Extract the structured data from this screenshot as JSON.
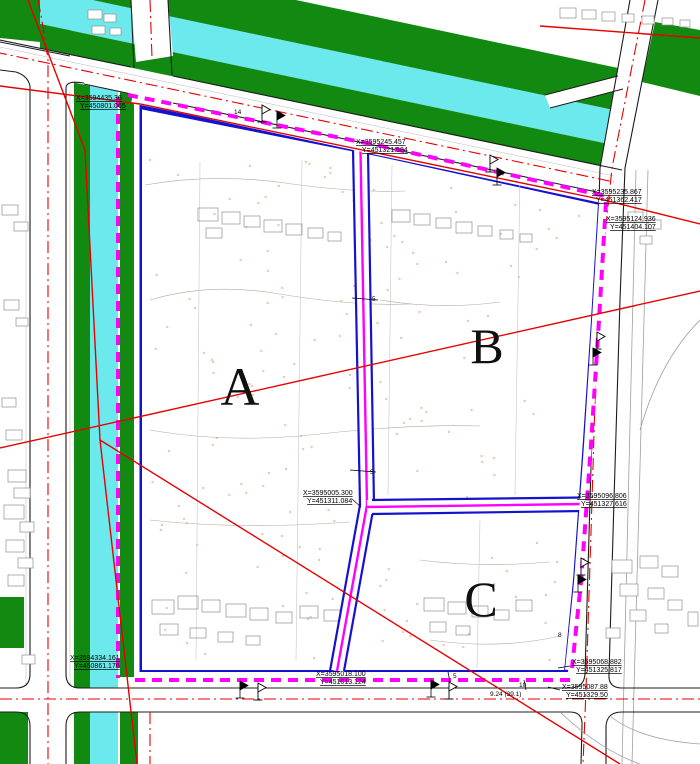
{
  "map": {
    "type": "cad-site-plan",
    "parcel_labels": {
      "a": "A",
      "b": "B",
      "c": "C"
    },
    "coordinate_labels": [
      {
        "x": "X=3594435.36",
        "y": "Y=450801.065"
      },
      {
        "x": "X=3595245.457",
        "y": "Y=451321.584"
      },
      {
        "x": "X=3595235.867",
        "y": "Y=451362.417"
      },
      {
        "x": "X=3595124.936",
        "y": "Y=451404.107"
      },
      {
        "x": "X=3595005.300",
        "y": "Y=451311.084"
      },
      {
        "x": "X=3595096.806",
        "y": "Y=451327.616"
      },
      {
        "x": "X=3594334.161",
        "y": "Y=450861.176"
      },
      {
        "x": "X=3595018.100",
        "y": "Y=451013.124"
      },
      {
        "x": "X=3595068.882",
        "y": "Y=451325.817"
      },
      {
        "x": "X=3595087.88",
        "y": "Y=451329.50"
      }
    ],
    "tick_labels": [
      "14",
      "5",
      "5",
      "5",
      "10",
      "9.24 (39.1)",
      "8"
    ],
    "colors": {
      "parcel": "#d78a6e",
      "boundary_blue": "#1512cf",
      "boundary_magenta": "#ff00fc",
      "canal_cyan": "#6ce9ec",
      "green_strip": "#128a12",
      "red_line": "#e60000"
    }
  }
}
